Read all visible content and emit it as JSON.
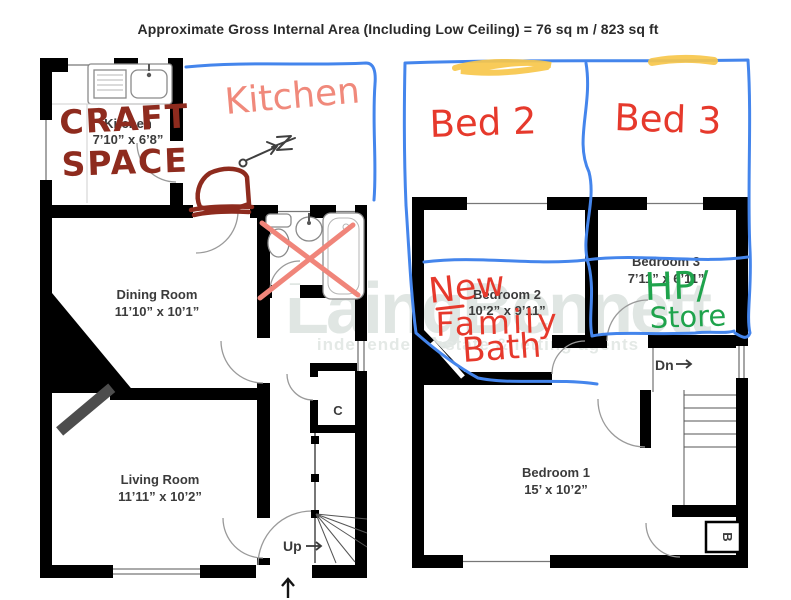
{
  "title": "Approximate Gross Internal Area (Including Low Ceiling) =  76 sq m / 823 sq ft",
  "watermark": {
    "brand": "LaingBennett",
    "tagline": "independent estate & letting agents"
  },
  "ground_floor": {
    "kitchen": {
      "name": "Kitchen",
      "dims": "7’10” x 6’8”"
    },
    "dining_room": {
      "name": "Dining Room",
      "dims": "11’10” x 10’1”"
    },
    "living_room": {
      "name": "Living Room",
      "dims": "11’11” x 10’2”"
    },
    "cupboard_label": "C",
    "stairs_label": "Up"
  },
  "first_floor": {
    "bedroom_1": {
      "name": "Bedroom 1",
      "dims": "15’ x 10’2”"
    },
    "bedroom_2": {
      "name": "Bedroom 2",
      "dims": "10’2” x 9’11”"
    },
    "bedroom_3": {
      "name": "Bedroom 3",
      "dims": "7’11” x 6’11”"
    },
    "stairs_label": "Dn",
    "boiler_label": "B"
  },
  "annotations": {
    "craft_space_line1": "CRAFT",
    "craft_space_line2": "SPACE",
    "kitchen_handwritten": "Kitchen",
    "bed2": "Bed 2",
    "bed3": "Bed 3",
    "new_family_bath_line1": "New",
    "new_family_bath_line2": "Family",
    "new_family_bath_line3": "Bath",
    "hp_store_line1": "HP/",
    "hp_store_line2": "Store",
    "colors": {
      "red": "#e6392c",
      "salmon": "#f0897b",
      "maroon": "#8e2b1e",
      "blue": "#4485ec",
      "green": "#1fa34c",
      "yellow": "#f7c74b",
      "pencil": "#3f3f3f"
    }
  }
}
